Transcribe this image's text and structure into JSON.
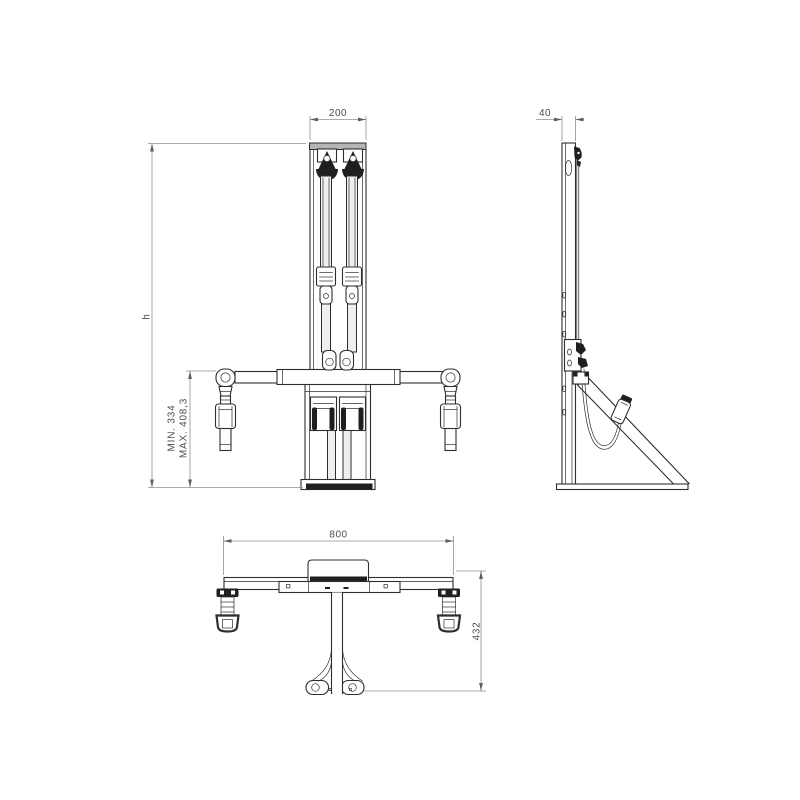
{
  "colors": {
    "bg": "#ffffff",
    "line": "#2e2e2e",
    "dark": "#1f1f1f",
    "gray": "#b4b4b4",
    "belt": "#efefef",
    "dim": "#8f8f8f",
    "dimarrow": "#5f5f5f",
    "text": "#4c4c4c"
  },
  "dims": {
    "front_width": "200",
    "front_height": "h",
    "drop_min": "MIN. 334",
    "drop_max": "MAX. 408,3",
    "side_depth": "40",
    "base_width": "800",
    "base_depth": "432"
  }
}
